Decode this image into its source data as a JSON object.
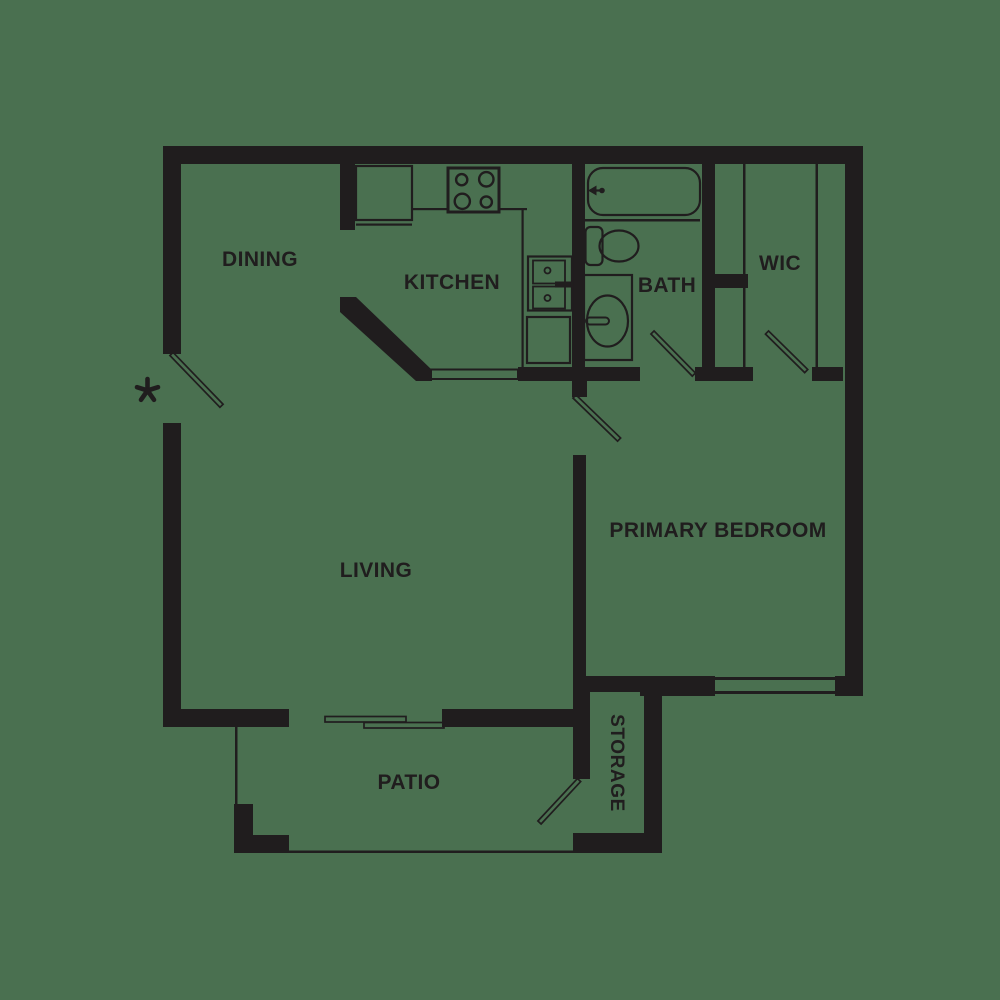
{
  "plan": {
    "type": "apartment-floor-plan",
    "colors": {
      "background": "#4a7050",
      "ink": "#201d1e"
    },
    "rooms": {
      "dining": "DINING",
      "kitchen": "KITCHEN",
      "bath": "BATH",
      "wic": "WIC",
      "primary_bedroom": "PRIMARY BEDROOM",
      "living": "LIVING",
      "patio": "PATIO",
      "storage": "STORAGE"
    },
    "markers": {
      "entry_asterisk": "*"
    },
    "fixtures": [
      "refrigerator",
      "range-4-burner",
      "kitchen-double-sink",
      "kitchen-counter",
      "dishwasher-counter",
      "pass-through-counter",
      "bathtub",
      "tub-faucet",
      "toilet",
      "vanity-sink",
      "vanity-faucet",
      "closet-rod-lines",
      "sliding-glass-door",
      "bedroom-window",
      "patio-step",
      "entry-door",
      "bedroom-door",
      "bath-door",
      "wic-door",
      "storage-door"
    ]
  }
}
